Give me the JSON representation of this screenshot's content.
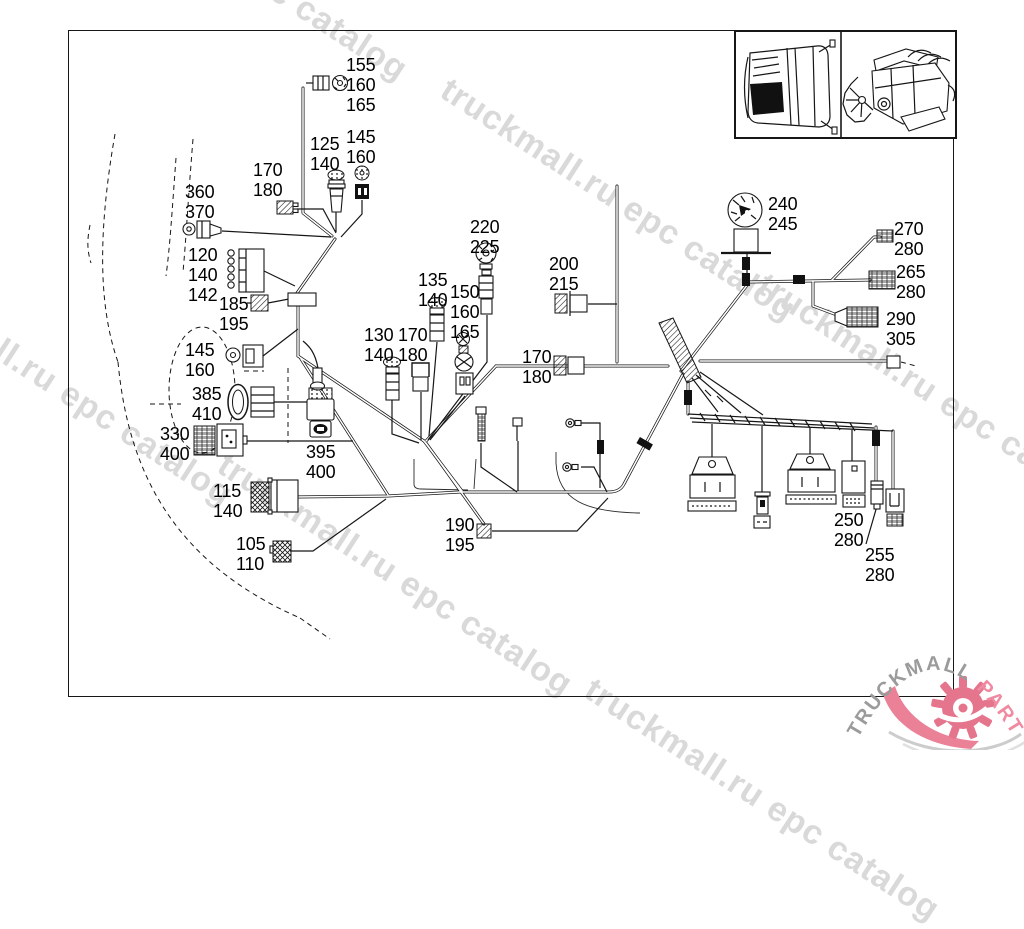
{
  "page": {
    "background": "#ffffff",
    "border_color": "#161616",
    "type_label": "wiring-harness-parts-diagram"
  },
  "watermark": {
    "text": "truckmall.ru epc catalog",
    "color": "#d9d9d9"
  },
  "logo": {
    "brand_gray": "TRUCKMALL",
    "brand_pink": "PARTS",
    "gray_color": "#9b9b9b",
    "pink_color": "#ef8aa0",
    "gear_color": "#e5758c"
  },
  "inset": {
    "panels": [
      "truck-cab-top-view",
      "engine-side-view"
    ]
  },
  "callouts": [
    {
      "id": "155-160-165",
      "x": 346,
      "y": 55,
      "lines": [
        "155",
        "160",
        "165"
      ]
    },
    {
      "id": "125-140",
      "x": 310,
      "y": 134,
      "lines": [
        "125",
        "140"
      ]
    },
    {
      "id": "145-160-a",
      "x": 346,
      "y": 127,
      "lines": [
        "145",
        "160"
      ]
    },
    {
      "id": "170-180-a",
      "x": 253,
      "y": 160,
      "lines": [
        "170",
        "180"
      ]
    },
    {
      "id": "360-370",
      "x": 185,
      "y": 182,
      "lines": [
        "360",
        "370"
      ]
    },
    {
      "id": "120-140-142",
      "x": 188,
      "y": 245,
      "lines": [
        "120",
        "140",
        "142"
      ]
    },
    {
      "id": "185-195",
      "x": 219,
      "y": 294,
      "lines": [
        "185",
        "195"
      ]
    },
    {
      "id": "145-160-b",
      "x": 185,
      "y": 340,
      "lines": [
        "145",
        "160"
      ]
    },
    {
      "id": "385-410",
      "x": 192,
      "y": 384,
      "lines": [
        "385",
        "410"
      ]
    },
    {
      "id": "330-400",
      "x": 160,
      "y": 424,
      "lines": [
        "330",
        "400"
      ]
    },
    {
      "id": "395-400",
      "x": 306,
      "y": 442,
      "lines": [
        "395",
        "400"
      ]
    },
    {
      "id": "115-140",
      "x": 213,
      "y": 481,
      "lines": [
        "115",
        "140"
      ]
    },
    {
      "id": "105-110",
      "x": 236,
      "y": 534,
      "lines": [
        "105",
        "110"
      ]
    },
    {
      "id": "190-195",
      "x": 445,
      "y": 515,
      "lines": [
        "190",
        "195"
      ]
    },
    {
      "id": "220-225",
      "x": 470,
      "y": 217,
      "lines": [
        "220",
        "225"
      ]
    },
    {
      "id": "135-140",
      "x": 418,
      "y": 270,
      "lines": [
        "135",
        "140"
      ]
    },
    {
      "id": "150-160-165",
      "x": 450,
      "y": 282,
      "lines": [
        "150",
        "160",
        "165"
      ]
    },
    {
      "id": "130-140",
      "x": 364,
      "y": 325,
      "lines": [
        "130",
        "140"
      ]
    },
    {
      "id": "170-180-b",
      "x": 398,
      "y": 325,
      "lines": [
        "170",
        "180"
      ]
    },
    {
      "id": "200-215",
      "x": 549,
      "y": 254,
      "lines": [
        "200",
        "215"
      ]
    },
    {
      "id": "170-180-c",
      "x": 522,
      "y": 347,
      "lines": [
        "170",
        "180"
      ]
    },
    {
      "id": "240-245",
      "x": 768,
      "y": 194,
      "lines": [
        "240",
        "245"
      ]
    },
    {
      "id": "270-280",
      "x": 894,
      "y": 219,
      "lines": [
        "270",
        "280"
      ]
    },
    {
      "id": "265-280",
      "x": 896,
      "y": 262,
      "lines": [
        "265",
        "280"
      ]
    },
    {
      "id": "290-305",
      "x": 886,
      "y": 309,
      "lines": [
        "290",
        "305"
      ]
    },
    {
      "id": "250-280",
      "x": 834,
      "y": 510,
      "lines": [
        "250",
        "280"
      ]
    },
    {
      "id": "255-280",
      "x": 865,
      "y": 545,
      "lines": [
        "255",
        "280"
      ]
    }
  ]
}
